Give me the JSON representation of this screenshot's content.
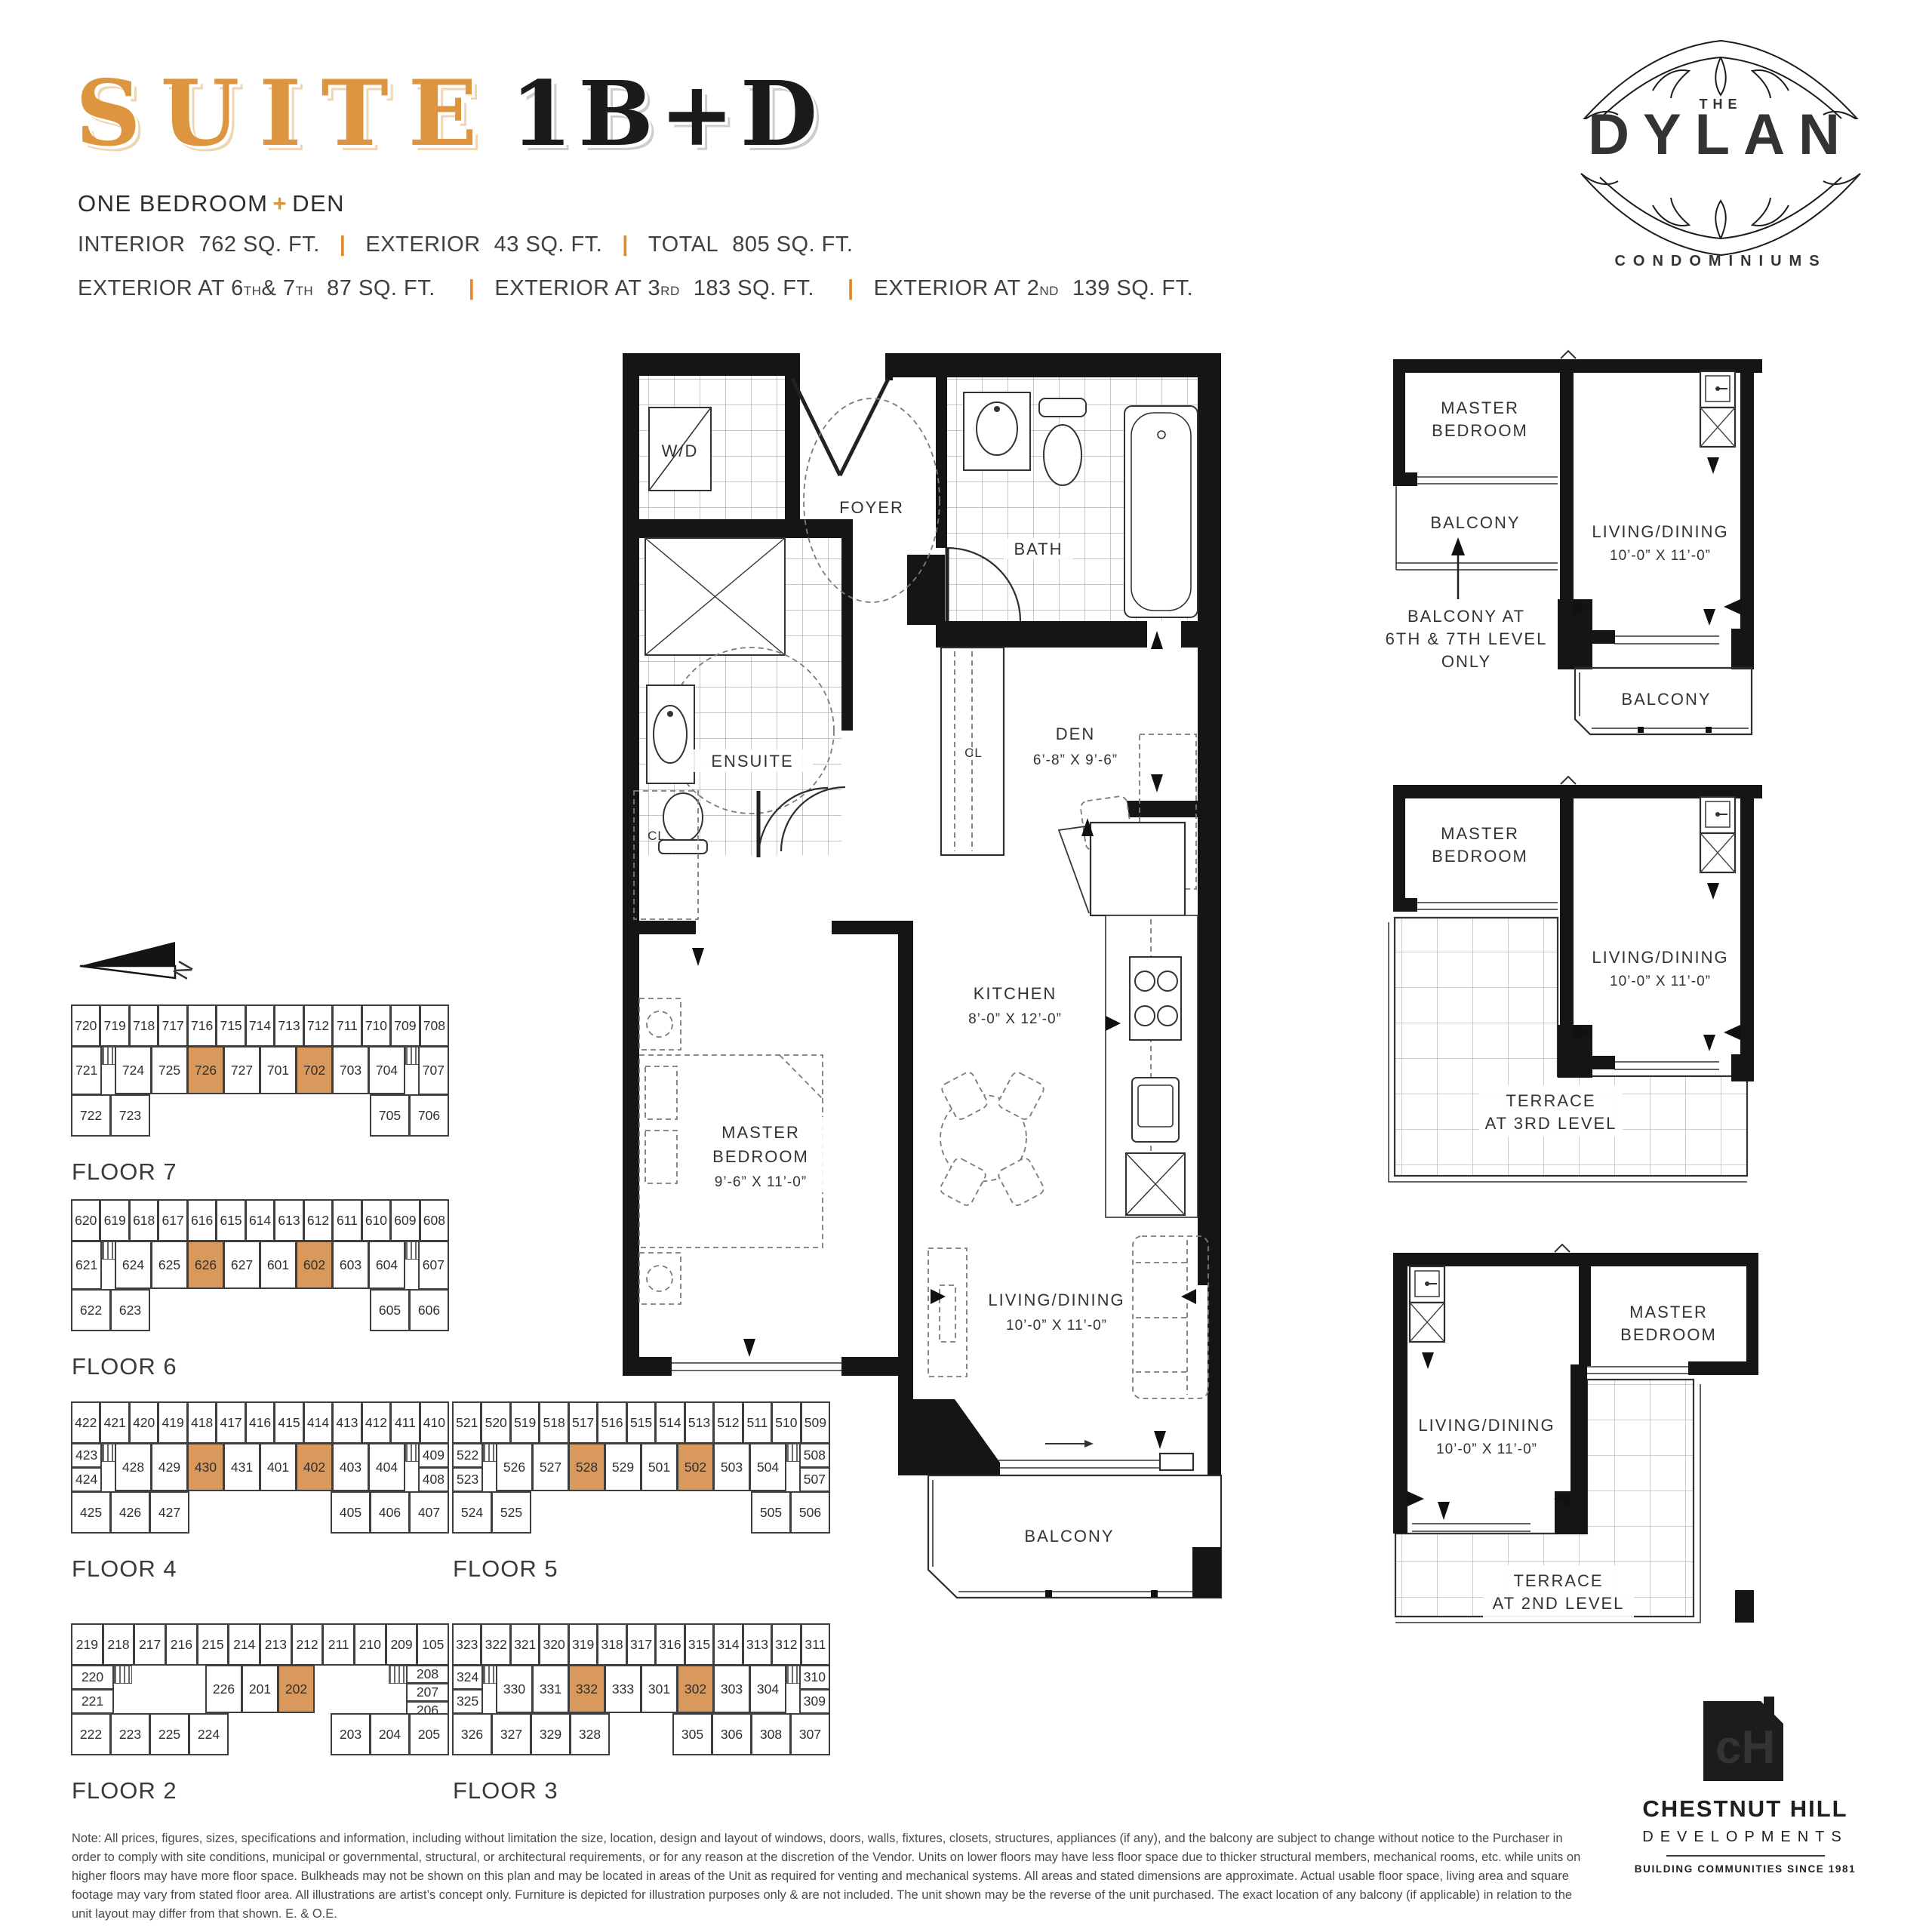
{
  "accent_orange": "#DD9540",
  "highlight_orange": "#D9995C",
  "header": {
    "suite_word": "SUITE",
    "suite_code": "1B+D",
    "subtitle_a": "ONE BEDROOM",
    "subtitle_plus": "+",
    "subtitle_b": "DEN",
    "sep": "|"
  },
  "stats": {
    "interior_label": "INTERIOR",
    "interior_value": "762 SQ. FT.",
    "exterior_label": "EXTERIOR",
    "exterior_value": "43 SQ. FT.",
    "total_label": "TOTAL",
    "total_value": "805 SQ. FT.",
    "ext67_label": "EXTERIOR AT 6",
    "ext67_sup1": "TH",
    "ext67_mid": " & 7",
    "ext67_sup2": "TH",
    "ext67_value": "87 SQ. FT.",
    "ext3_label": "EXTERIOR AT 3",
    "ext3_sup": "RD",
    "ext3_value": "183 SQ. FT.",
    "ext2_label": "EXTERIOR AT 2",
    "ext2_sup": "ND",
    "ext2_value": "139 SQ. FT."
  },
  "logo_dylan": {
    "the": "THE",
    "name": "DYLAN",
    "sub": "CONDOMINIUMS"
  },
  "plan": {
    "wd": "W/D",
    "foyer": "FOYER",
    "bath": "BATH",
    "ensuite": "ENSUITE",
    "cl_den": "CL",
    "cl_hall": "CL",
    "den": "DEN",
    "den_dims": "6’-8” X 9’-6”",
    "kitchen": "KITCHEN",
    "kitchen_dims": "8’-0” X 12’-0”",
    "master1": "MASTER",
    "master2": "BEDROOM",
    "master_dims": "9’-6” X 11’-0”",
    "living": "LIVING/DINING",
    "living_dims": "10’-0” X 11’-0”",
    "balcony": "BALCONY"
  },
  "variants": [
    {
      "master1": "MASTER",
      "master2": "BEDROOM",
      "balcony_upper": "BALCONY",
      "living": "LIVING/DINING",
      "living_dims": "10’-0” X 11’-0”",
      "balcony_lower": "BALCONY",
      "note1": "BALCONY AT",
      "note2": "6TH & 7TH LEVEL",
      "note3": "ONLY"
    },
    {
      "master1": "MASTER",
      "master2": "BEDROOM",
      "living": "LIVING/DINING",
      "living_dims": "10’-0” X 11’-0”",
      "terrace1": "TERRACE",
      "terrace2": "AT 3RD LEVEL"
    },
    {
      "master1": "MASTER",
      "master2": "BEDROOM",
      "living": "LIVING/DINING",
      "living_dims": "10’-0” X 11’-0”",
      "terrace1": "TERRACE",
      "terrace2": "AT 2ND LEVEL"
    }
  ],
  "north_label": "N",
  "floors": [
    {
      "name": "FLOOR 7",
      "top": [
        "720",
        "719",
        "718",
        "717",
        "716",
        "715",
        "714",
        "713",
        "712",
        "711",
        "710",
        "709",
        "708"
      ],
      "mid_left": [
        "721"
      ],
      "mid": [
        "724",
        "725",
        "726",
        "727",
        "701",
        "702",
        "703",
        "704"
      ],
      "mid_right": [
        "707"
      ],
      "bottom_left": [
        "722",
        "723"
      ],
      "bottom_right": [
        "705",
        "706"
      ],
      "highlight": [
        "726",
        "702"
      ]
    },
    {
      "name": "FLOOR 6",
      "top": [
        "620",
        "619",
        "618",
        "617",
        "616",
        "615",
        "614",
        "613",
        "612",
        "611",
        "610",
        "609",
        "608"
      ],
      "mid_left": [
        "621"
      ],
      "mid": [
        "624",
        "625",
        "626",
        "627",
        "601",
        "602",
        "603",
        "604"
      ],
      "mid_right": [
        "607"
      ],
      "bottom_left": [
        "622",
        "623"
      ],
      "bottom_right": [
        "605",
        "606"
      ],
      "highlight": [
        "626",
        "602"
      ]
    },
    {
      "name": "FLOOR 4",
      "top": [
        "422",
        "421",
        "420",
        "419",
        "418",
        "417",
        "416",
        "415",
        "414",
        "413",
        "412",
        "411",
        "410"
      ],
      "mid_left": [
        "423",
        "424"
      ],
      "mid": [
        "428",
        "429",
        "430",
        "431",
        "401",
        "402",
        "403",
        "404"
      ],
      "mid_right": [
        "409",
        "408"
      ],
      "bottom_left": [
        "425",
        "426",
        "427"
      ],
      "bottom_right": [
        "405",
        "406",
        "407"
      ],
      "highlight": [
        "430",
        "402"
      ]
    },
    {
      "name": "FLOOR 5",
      "top": [
        "521",
        "520",
        "519",
        "518",
        "517",
        "516",
        "515",
        "514",
        "513",
        "512",
        "511",
        "510",
        "509"
      ],
      "mid_left": [
        "522",
        "523"
      ],
      "mid": [
        "526",
        "527",
        "528",
        "529",
        "501",
        "502",
        "503",
        "504"
      ],
      "mid_right": [
        "508",
        "507"
      ],
      "bottom_left": [
        "524",
        "525"
      ],
      "bottom_right": [
        "505",
        "506"
      ],
      "highlight": [
        "528",
        "502"
      ]
    },
    {
      "name": "FLOOR 2",
      "top": [
        "219",
        "218",
        "217",
        "216",
        "215",
        "214",
        "213",
        "212",
        "211",
        "210",
        "209",
        "105"
      ],
      "mid_left": [
        "220",
        "221"
      ],
      "mid": [
        "226",
        "201",
        "202"
      ],
      "mid_right": [
        "208",
        "207",
        "206"
      ],
      "bottom_left": [
        "222",
        "223",
        "225",
        "224"
      ],
      "bottom_right": [
        "203",
        "204",
        "205"
      ],
      "highlight": [
        "202"
      ]
    },
    {
      "name": "FLOOR 3",
      "top": [
        "323",
        "322",
        "321",
        "320",
        "319",
        "318",
        "317",
        "316",
        "315",
        "314",
        "313",
        "312",
        "311"
      ],
      "mid_left": [
        "324",
        "325"
      ],
      "mid": [
        "330",
        "331",
        "332",
        "333",
        "301",
        "302",
        "303",
        "304"
      ],
      "mid_right": [
        "310",
        "309"
      ],
      "bottom_left": [
        "326",
        "327",
        "329",
        "328"
      ],
      "bottom_right": [
        "305",
        "306",
        "308",
        "307"
      ],
      "highlight": [
        "332",
        "302"
      ]
    }
  ],
  "footer_note": "Note:  All prices, figures, sizes, specifications and information, including without limitation the size, location, design and layout of windows, doors, walls, fixtures, closets, structures, appliances (if any), and the balcony are subject to change without notice to the Purchaser in order to comply with site conditions, municipal or governmental, structural, or architectural requirements, or for any reason at the discretion of the Vendor. Units on lower floors may have less floor space due to thicker structural members, mechanical rooms, etc. while units on higher floors may have more floor space. Bulkheads may not be shown on this plan and may be located in areas of the Unit as required for venting and mechanical systems. All areas and stated dimensions are approximate. Actual usable floor space, living area and square footage may vary from stated floor area. All illustrations are artist’s concept only. Furniture is depicted for illustration purposes only & are not included. The unit shown may be the reverse of the unit purchased. The exact location of any balcony (if applicable) in relation to the unit layout may differ from that shown. E. & O.E.",
  "logo_chestnut": {
    "monogram": "cH",
    "name": "CHESTNUT HILL",
    "sub": "DEVELOPMENTS",
    "tagline": "BUILDING COMMUNITIES SINCE 1981"
  }
}
